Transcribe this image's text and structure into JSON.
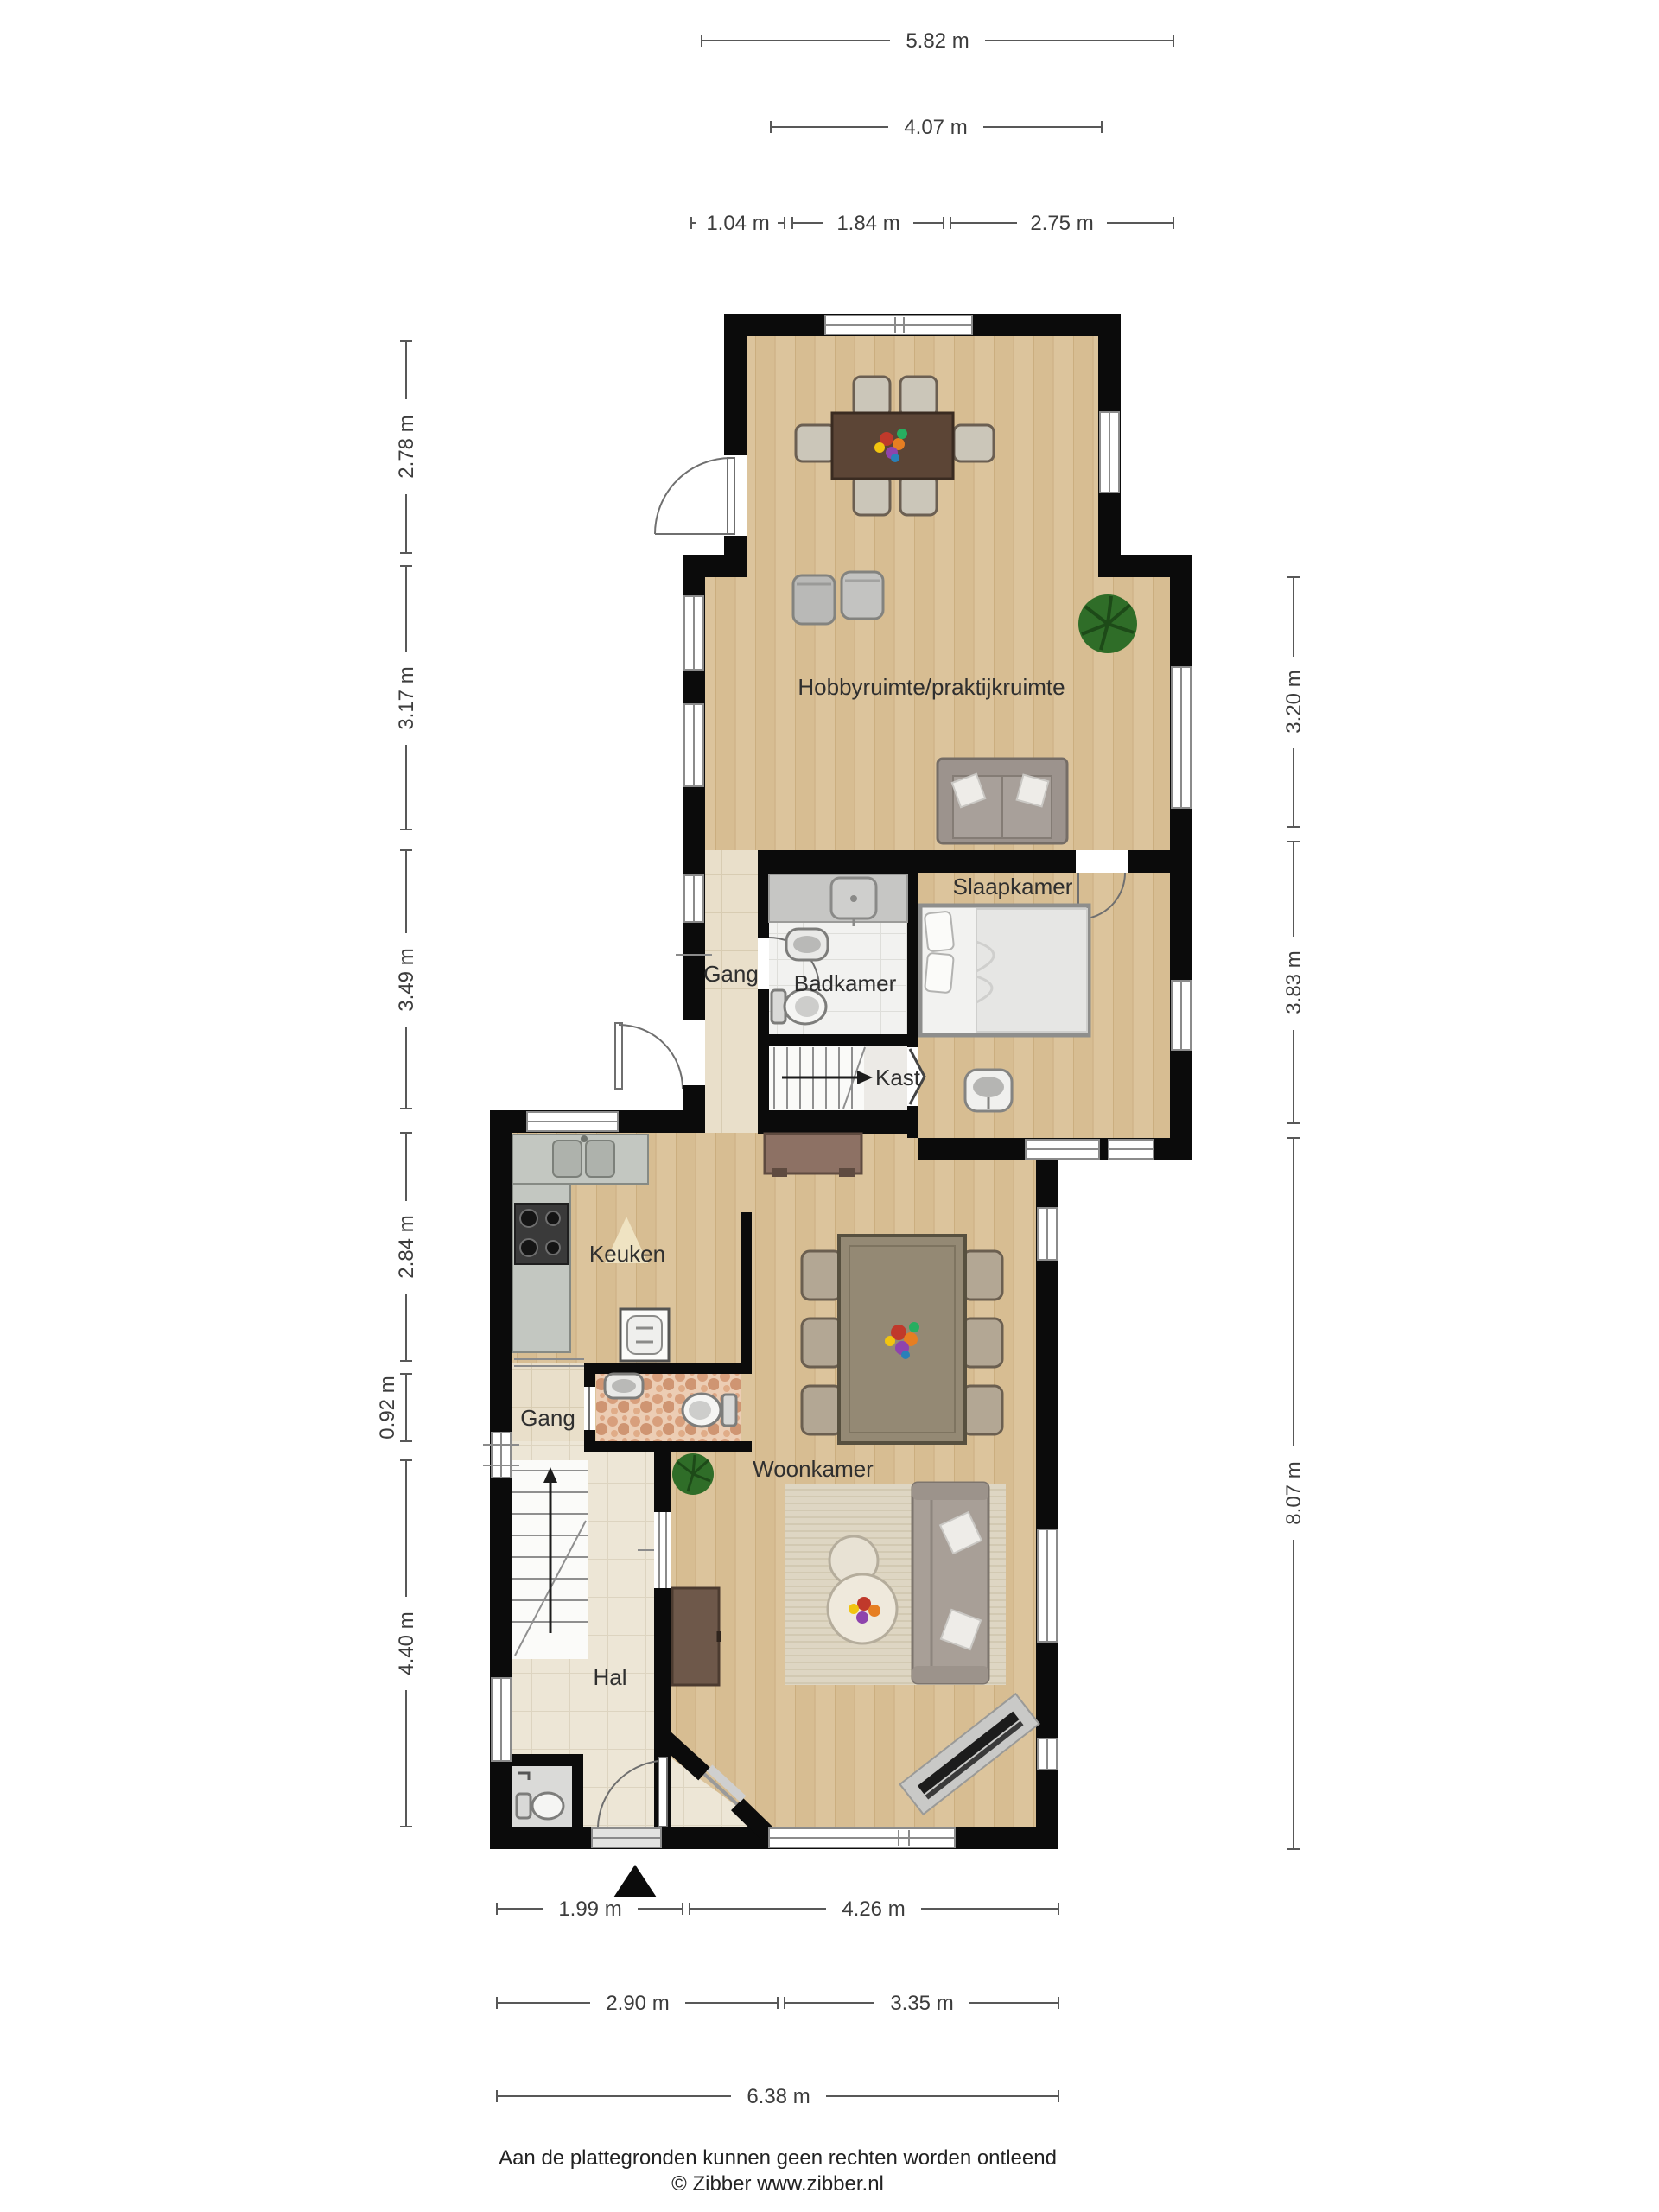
{
  "plan_title": "Begane grond plattegrond",
  "rooms": {
    "hobby": "Hobbyruimte/praktijkruimte",
    "slaapkamer": "Slaapkamer",
    "gang_boven": "Gang",
    "badkamer": "Badkamer",
    "kast": "Kast",
    "keuken": "Keuken",
    "gang_beneden": "Gang",
    "woonkamer": "Woonkamer",
    "hal": "Hal"
  },
  "dimensions": {
    "top": [
      "5.82 m",
      "4.07 m",
      "1.04 m",
      "1.84 m",
      "2.75 m"
    ],
    "left": [
      "2.78 m",
      "3.17 m",
      "3.49 m",
      "2.84 m",
      "0.92 m",
      "4.40 m"
    ],
    "right": [
      "3.20 m",
      "3.83 m",
      "8.07 m"
    ],
    "bottom": [
      "1.99 m",
      "4.26 m",
      "2.90 m",
      "3.35 m",
      "6.38 m"
    ]
  },
  "footer": {
    "disclaimer": "Aan de plattegronden kunnen geen rechten worden ontleend",
    "credit": "© Zibber www.zibber.nl"
  },
  "colors": {
    "wall": "#0b0b0b",
    "wood_floor": "#dcc49c",
    "tile_beige": "#e9dfca",
    "tile_hal": "#ede6d6",
    "tile_white": "#f2f2f0",
    "mosaic": "#e0b294",
    "counter_gray": "#c3c7c1",
    "sofa_taupe": "#a89f97",
    "table_brown": "#5c4536",
    "rug": "#ded6c3",
    "plant_green": "#2f6d28"
  }
}
